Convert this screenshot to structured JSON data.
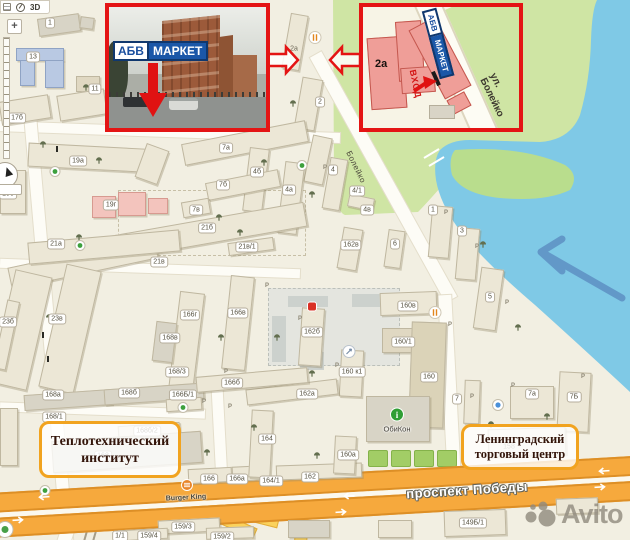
{
  "controls": {
    "toolbar_3d": "3D",
    "zoom_in": "+"
  },
  "insets": {
    "photo": {
      "sign": {
        "abv": "АБВ",
        "market": "МАРКЕТ"
      }
    },
    "plan": {
      "building": "2а",
      "sign": {
        "abv": "АБВ",
        "market": "МАРКЕТ"
      },
      "entrance": "ВХОД",
      "street": "ул. Болейко"
    }
  },
  "callouts": {
    "institute": {
      "line1": "Теплотехнический",
      "line2": "институт"
    },
    "trade_center": {
      "line1": "Ленинградский",
      "line2": "торговый центр"
    }
  },
  "roads": {
    "prospekt": "проспект Победы",
    "boleyko": "Болейко"
  },
  "pois_text": {
    "burger_king": "Burger King",
    "obikon": "ОбиКон"
  },
  "watermark": {
    "text": "Avito"
  },
  "colors": {
    "inset_border": "#e41414",
    "callout_border": "#f1a31f",
    "water": "#7fc9e6",
    "green": "#cfe5a4",
    "road_orange": "#f6a93d",
    "building_pink": "#ef9e98",
    "sign_blue": "#1a57a8",
    "avito_gray": "#908a7e"
  },
  "map": {
    "labels": [
      {
        "t": "1",
        "x": 50,
        "y": 23
      },
      {
        "t": "13",
        "x": 33,
        "y": 57
      },
      {
        "t": "11",
        "x": 95,
        "y": 89
      },
      {
        "t": "17б",
        "x": 17,
        "y": 118
      },
      {
        "t": "19а",
        "x": 78,
        "y": 161
      },
      {
        "t": "19б",
        "x": 8,
        "y": 194
      },
      {
        "t": "19г",
        "x": 111,
        "y": 205
      },
      {
        "t": "21а",
        "x": 56,
        "y": 244
      },
      {
        "t": "2а",
        "x": 294,
        "y": 49,
        "s": "plain"
      },
      {
        "t": "2",
        "x": 320,
        "y": 102
      },
      {
        "t": "7а",
        "x": 226,
        "y": 148
      },
      {
        "t": "4б",
        "x": 257,
        "y": 172
      },
      {
        "t": "7б",
        "x": 223,
        "y": 185
      },
      {
        "t": "4а",
        "x": 289,
        "y": 190
      },
      {
        "t": "7в",
        "x": 196,
        "y": 210
      },
      {
        "t": "21б",
        "x": 207,
        "y": 228
      },
      {
        "t": "21в/1",
        "x": 247,
        "y": 247
      },
      {
        "t": "21в",
        "x": 159,
        "y": 262
      },
      {
        "t": "4",
        "x": 333,
        "y": 170
      },
      {
        "t": "4/1",
        "x": 357,
        "y": 191
      },
      {
        "t": "4в",
        "x": 367,
        "y": 210
      },
      {
        "t": "1",
        "x": 433,
        "y": 210
      },
      {
        "t": "3",
        "x": 462,
        "y": 231
      },
      {
        "t": "6",
        "x": 395,
        "y": 244
      },
      {
        "t": "162в",
        "x": 351,
        "y": 245
      },
      {
        "t": "5",
        "x": 490,
        "y": 297
      },
      {
        "t": "23б",
        "x": 8,
        "y": 322
      },
      {
        "t": "23в",
        "x": 57,
        "y": 319
      },
      {
        "t": "166г",
        "x": 190,
        "y": 315
      },
      {
        "t": "166в",
        "x": 238,
        "y": 313
      },
      {
        "t": "168в",
        "x": 170,
        "y": 338
      },
      {
        "t": "162б",
        "x": 312,
        "y": 332
      },
      {
        "t": "168/3",
        "x": 177,
        "y": 372
      },
      {
        "t": "160в",
        "x": 408,
        "y": 306
      },
      {
        "t": "160/1",
        "x": 403,
        "y": 342
      },
      {
        "t": "160 к1",
        "x": 352,
        "y": 372
      },
      {
        "t": "160",
        "x": 429,
        "y": 377
      },
      {
        "t": "166б",
        "x": 232,
        "y": 383
      },
      {
        "t": "162а",
        "x": 307,
        "y": 394
      },
      {
        "t": "168а",
        "x": 53,
        "y": 395
      },
      {
        "t": "168б",
        "x": 129,
        "y": 393
      },
      {
        "t": "166Б/1",
        "x": 183,
        "y": 395
      },
      {
        "t": "168/1",
        "x": 54,
        "y": 417
      },
      {
        "t": "168б/2",
        "x": 147,
        "y": 431
      },
      {
        "t": "168",
        "x": 103,
        "y": 456
      },
      {
        "t": "164",
        "x": 267,
        "y": 439
      },
      {
        "t": "160а",
        "x": 348,
        "y": 455
      },
      {
        "t": "166",
        "x": 209,
        "y": 479
      },
      {
        "t": "166а",
        "x": 237,
        "y": 479
      },
      {
        "t": "164/1",
        "x": 271,
        "y": 481
      },
      {
        "t": "162",
        "x": 310,
        "y": 477
      },
      {
        "t": "7",
        "x": 457,
        "y": 399
      },
      {
        "t": "7а",
        "x": 532,
        "y": 394
      },
      {
        "t": "7Б",
        "x": 574,
        "y": 397
      },
      {
        "t": "158",
        "x": 509,
        "y": 447,
        "s": "plain"
      },
      {
        "t": "149Б/1",
        "x": 473,
        "y": 523
      },
      {
        "t": "159/3",
        "x": 183,
        "y": 527
      },
      {
        "t": "159/4",
        "x": 149,
        "y": 536
      },
      {
        "t": "1/1",
        "x": 120,
        "y": 536
      },
      {
        "t": "159/2",
        "x": 222,
        "y": 537
      }
    ],
    "buildings": [
      {
        "x": 38,
        "y": 16,
        "w": 42,
        "h": 18,
        "r": -8,
        "c": "b-gray"
      },
      {
        "x": 80,
        "y": 17,
        "w": 14,
        "h": 12,
        "r": 8,
        "c": "b-gray"
      },
      {
        "x": 16,
        "y": 48,
        "w": 48,
        "h": 13,
        "r": 0,
        "c": "b-blue"
      },
      {
        "x": 20,
        "y": 60,
        "w": 15,
        "h": 26,
        "r": 0,
        "c": "b-blue"
      },
      {
        "x": 45,
        "y": 60,
        "w": 19,
        "h": 28,
        "r": 0,
        "c": "b-blue"
      },
      {
        "x": 76,
        "y": 76,
        "w": 24,
        "h": 16,
        "r": 0,
        "c": "b-tan"
      },
      {
        "x": 0,
        "y": 98,
        "w": 50,
        "h": 24,
        "r": -9,
        "c": "b-plain"
      },
      {
        "x": 58,
        "y": 92,
        "w": 48,
        "h": 26,
        "r": -9,
        "c": "b-plain"
      },
      {
        "x": 286,
        "y": 14,
        "w": 18,
        "h": 56,
        "r": 10,
        "c": "b-plain"
      },
      {
        "x": 298,
        "y": 78,
        "w": 21,
        "h": 52,
        "r": 10,
        "c": "b-plain"
      },
      {
        "x": 308,
        "y": 136,
        "w": 20,
        "h": 48,
        "r": 12,
        "c": "b-plain"
      },
      {
        "x": 28,
        "y": 146,
        "w": 132,
        "h": 24,
        "r": 3,
        "c": "b-plain"
      },
      {
        "x": 140,
        "y": 146,
        "w": 24,
        "h": 36,
        "r": 20,
        "c": "b-plain"
      },
      {
        "x": 0,
        "y": 170,
        "w": 26,
        "h": 44,
        "r": 0,
        "c": "b-plain"
      },
      {
        "x": 92,
        "y": 196,
        "w": 24,
        "h": 22,
        "r": 0,
        "c": "b-pink"
      },
      {
        "x": 118,
        "y": 192,
        "w": 28,
        "h": 24,
        "r": 0,
        "c": "b-pink"
      },
      {
        "x": 148,
        "y": 198,
        "w": 20,
        "h": 16,
        "r": 0,
        "c": "b-pink"
      },
      {
        "x": 182,
        "y": 132,
        "w": 126,
        "h": 22,
        "r": -11,
        "c": "b-plain"
      },
      {
        "x": 246,
        "y": 148,
        "w": 20,
        "h": 64,
        "r": 7,
        "c": "b-plain"
      },
      {
        "x": 206,
        "y": 176,
        "w": 74,
        "h": 18,
        "r": -11,
        "c": "b-plain"
      },
      {
        "x": 281,
        "y": 162,
        "w": 20,
        "h": 72,
        "r": 7,
        "c": "b-plain"
      },
      {
        "x": 182,
        "y": 200,
        "w": 28,
        "h": 16,
        "r": -10,
        "c": "b-plain"
      },
      {
        "x": 95,
        "y": 220,
        "w": 212,
        "h": 25,
        "r": -10,
        "c": "b-plain"
      },
      {
        "x": 228,
        "y": 240,
        "w": 46,
        "h": 13,
        "r": -8,
        "c": "b-plain"
      },
      {
        "x": 8,
        "y": 252,
        "w": 150,
        "h": 22,
        "r": -12,
        "c": "b-plain"
      },
      {
        "x": 28,
        "y": 236,
        "w": 152,
        "h": 22,
        "r": -5,
        "c": "b-plain"
      },
      {
        "x": 2,
        "y": 272,
        "w": 38,
        "h": 116,
        "r": 13,
        "c": "b-plain"
      },
      {
        "x": 52,
        "y": 266,
        "w": 36,
        "h": 126,
        "r": 13,
        "c": "b-plain"
      },
      {
        "x": 326,
        "y": 158,
        "w": 18,
        "h": 52,
        "r": 10,
        "c": "b-plain"
      },
      {
        "x": 348,
        "y": 196,
        "w": 26,
        "h": 13,
        "r": 12,
        "c": "b-plain"
      },
      {
        "x": 340,
        "y": 228,
        "w": 20,
        "h": 42,
        "r": 10,
        "c": "b-plain"
      },
      {
        "x": 386,
        "y": 230,
        "w": 17,
        "h": 38,
        "r": 8,
        "c": "b-plain"
      },
      {
        "x": 430,
        "y": 206,
        "w": 21,
        "h": 52,
        "r": 5,
        "c": "b-plain"
      },
      {
        "x": 457,
        "y": 228,
        "w": 21,
        "h": 52,
        "r": 5,
        "c": "b-plain"
      },
      {
        "x": 477,
        "y": 268,
        "w": 23,
        "h": 62,
        "r": 8,
        "c": "b-plain"
      },
      {
        "x": 174,
        "y": 292,
        "w": 25,
        "h": 100,
        "r": 7,
        "c": "b-plain"
      },
      {
        "x": 226,
        "y": 276,
        "w": 24,
        "h": 94,
        "r": 6,
        "c": "b-plain"
      },
      {
        "x": 154,
        "y": 322,
        "w": 21,
        "h": 40,
        "r": 7,
        "c": "b-gray"
      },
      {
        "x": 300,
        "y": 308,
        "w": 23,
        "h": 58,
        "r": 4,
        "c": "b-plain"
      },
      {
        "x": 380,
        "y": 292,
        "w": 57,
        "h": 23,
        "r": -2,
        "c": "b-plain"
      },
      {
        "x": 382,
        "y": 328,
        "w": 43,
        "h": 25,
        "r": 0,
        "c": "b-tan"
      },
      {
        "x": 340,
        "y": 350,
        "w": 23,
        "h": 47,
        "r": 3,
        "c": "b-plain"
      },
      {
        "x": 410,
        "y": 322,
        "w": 35,
        "h": 106,
        "r": 2,
        "c": "b-olive"
      },
      {
        "x": 366,
        "y": 396,
        "w": 64,
        "h": 46,
        "r": 0,
        "c": "b-gray"
      },
      {
        "x": 464,
        "y": 380,
        "w": 16,
        "h": 44,
        "r": 2,
        "c": "b-plain"
      },
      {
        "x": 510,
        "y": 386,
        "w": 44,
        "h": 33,
        "r": 0,
        "c": "b-plain"
      },
      {
        "x": 558,
        "y": 372,
        "w": 32,
        "h": 60,
        "r": 3,
        "c": "b-plain"
      },
      {
        "x": 488,
        "y": 428,
        "w": 78,
        "h": 28,
        "r": -2,
        "c": "b-plain"
      },
      {
        "x": 24,
        "y": 392,
        "w": 88,
        "h": 16,
        "r": -4,
        "c": "b-gray"
      },
      {
        "x": 104,
        "y": 386,
        "w": 100,
        "h": 16,
        "r": -4,
        "c": "b-gray"
      },
      {
        "x": 166,
        "y": 398,
        "w": 36,
        "h": 13,
        "r": -4,
        "c": "b-plain"
      },
      {
        "x": 118,
        "y": 424,
        "w": 62,
        "h": 13,
        "r": -4,
        "c": "b-plain"
      },
      {
        "x": 52,
        "y": 436,
        "w": 150,
        "h": 32,
        "r": -4,
        "c": "b-gray"
      },
      {
        "x": 188,
        "y": 468,
        "w": 44,
        "h": 15,
        "r": -3,
        "c": "b-plain"
      },
      {
        "x": 232,
        "y": 466,
        "w": 30,
        "h": 15,
        "r": -3,
        "c": "b-plain"
      },
      {
        "x": 250,
        "y": 410,
        "w": 22,
        "h": 68,
        "r": 3,
        "c": "b-plain"
      },
      {
        "x": 276,
        "y": 464,
        "w": 86,
        "h": 15,
        "r": -2,
        "c": "b-plain"
      },
      {
        "x": 334,
        "y": 436,
        "w": 22,
        "h": 38,
        "r": 3,
        "c": "b-plain"
      },
      {
        "x": 246,
        "y": 384,
        "w": 92,
        "h": 16,
        "r": -7,
        "c": "b-plain"
      },
      {
        "x": 196,
        "y": 372,
        "w": 112,
        "h": 16,
        "r": -5,
        "c": "b-plain"
      },
      {
        "x": 444,
        "y": 510,
        "w": 62,
        "h": 26,
        "r": -2,
        "c": "b-plain"
      },
      {
        "x": 158,
        "y": 519,
        "w": 62,
        "h": 14,
        "r": -3,
        "c": "b-plain"
      },
      {
        "x": 118,
        "y": 529,
        "w": 50,
        "h": 11,
        "r": -3,
        "c": "b-plain"
      },
      {
        "x": 206,
        "y": 527,
        "w": 48,
        "h": 12,
        "r": -2,
        "c": "b-plain"
      },
      {
        "x": 288,
        "y": 520,
        "w": 42,
        "h": 18,
        "r": 0,
        "c": "b-gray"
      },
      {
        "x": 378,
        "y": 520,
        "w": 34,
        "h": 18,
        "r": 0,
        "c": "b-plain"
      },
      {
        "x": 556,
        "y": 498,
        "w": 42,
        "h": 16,
        "r": -2,
        "c": "b-plain"
      },
      {
        "x": 0,
        "y": 408,
        "w": 18,
        "h": 58,
        "r": 0,
        "c": "b-plain"
      },
      {
        "x": 0,
        "y": 300,
        "w": 13,
        "h": 70,
        "r": 12,
        "c": "b-plain"
      }
    ],
    "trees": [
      {
        "x": 86,
        "y": 87
      },
      {
        "x": 43,
        "y": 144
      },
      {
        "x": 99,
        "y": 160
      },
      {
        "x": 79,
        "y": 237
      },
      {
        "x": 264,
        "y": 162
      },
      {
        "x": 312,
        "y": 194
      },
      {
        "x": 219,
        "y": 217
      },
      {
        "x": 240,
        "y": 232
      },
      {
        "x": 303,
        "y": 165
      },
      {
        "x": 483,
        "y": 244
      },
      {
        "x": 518,
        "y": 327
      },
      {
        "x": 49,
        "y": 317
      },
      {
        "x": 221,
        "y": 337
      },
      {
        "x": 277,
        "y": 337
      },
      {
        "x": 312,
        "y": 373
      },
      {
        "x": 254,
        "y": 427
      },
      {
        "x": 317,
        "y": 455
      },
      {
        "x": 207,
        "y": 452
      },
      {
        "x": 491,
        "y": 424
      },
      {
        "x": 547,
        "y": 416
      },
      {
        "x": 293,
        "y": 103
      }
    ],
    "parkings": [
      {
        "x": 267,
        "y": 286
      },
      {
        "x": 300,
        "y": 319
      },
      {
        "x": 337,
        "y": 366
      },
      {
        "x": 226,
        "y": 372
      },
      {
        "x": 204,
        "y": 402
      },
      {
        "x": 446,
        "y": 213
      },
      {
        "x": 477,
        "y": 247
      },
      {
        "x": 507,
        "y": 303
      },
      {
        "x": 450,
        "y": 325
      },
      {
        "x": 583,
        "y": 377
      },
      {
        "x": 472,
        "y": 397
      },
      {
        "x": 513,
        "y": 386
      },
      {
        "x": 325,
        "y": 168
      },
      {
        "x": 230,
        "y": 407
      }
    ],
    "pois": [
      {
        "type": "restaurant",
        "x": 315,
        "y": 40
      },
      {
        "type": "restaurant",
        "x": 435,
        "y": 315
      },
      {
        "type": "red-shop",
        "x": 312,
        "y": 308
      },
      {
        "type": "nav",
        "x": 349,
        "y": 354
      },
      {
        "type": "info",
        "x": 397,
        "y": 417
      },
      {
        "type": "blue",
        "x": 498,
        "y": 407
      },
      {
        "type": "green",
        "x": 302,
        "y": 167
      },
      {
        "type": "green",
        "x": 80,
        "y": 247
      },
      {
        "type": "green",
        "x": 55,
        "y": 173
      },
      {
        "type": "green",
        "x": 45,
        "y": 492
      },
      {
        "type": "green",
        "x": 183,
        "y": 409
      },
      {
        "type": "burger",
        "x": 187,
        "y": 487
      },
      {
        "type": "figure",
        "x": 43,
        "y": 334
      },
      {
        "type": "figure",
        "x": 48,
        "y": 358
      },
      {
        "type": "figure",
        "x": 57,
        "y": 148
      },
      {
        "type": "corner-dot",
        "x": 5,
        "y": 532
      }
    ],
    "road_arrows": [
      {
        "x": 43,
        "y": 497,
        "d": "l"
      },
      {
        "x": 348,
        "y": 496,
        "d": "l"
      },
      {
        "x": 603,
        "y": 471,
        "d": "l"
      },
      {
        "x": 19,
        "y": 520,
        "d": "r"
      },
      {
        "x": 342,
        "y": 512,
        "d": "r"
      },
      {
        "x": 601,
        "y": 487,
        "d": "r"
      }
    ]
  }
}
